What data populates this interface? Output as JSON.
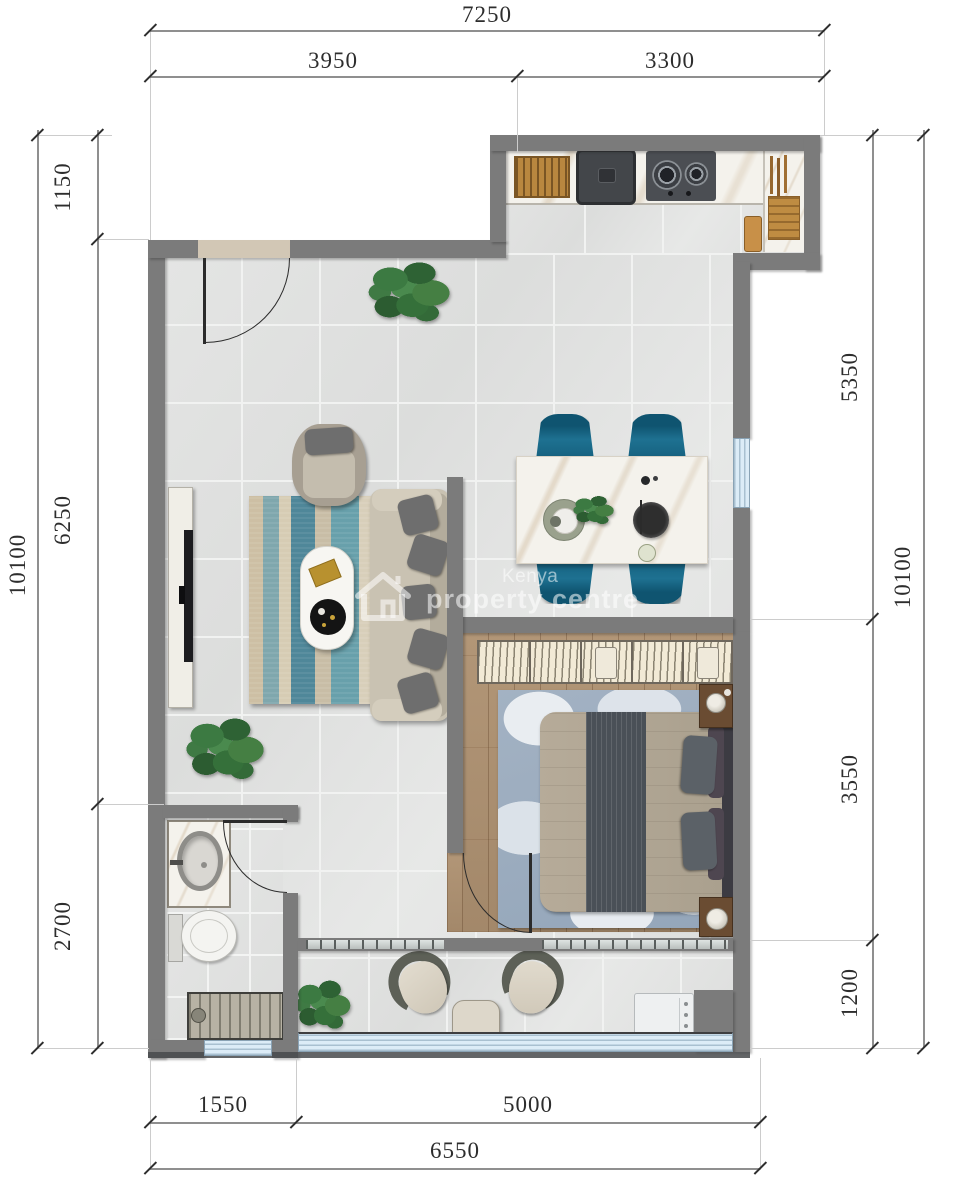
{
  "plan": {
    "watermark": {
      "brand_top": "Kenya",
      "brand_bottom": "property centre"
    },
    "dimensions_mm": {
      "top_total": "7250",
      "top_segments": [
        "3950",
        "3300"
      ],
      "bottom_total": "6550",
      "bottom_segments": [
        "1550",
        "5000"
      ],
      "left_total": "10100",
      "left_segments": [
        "1150",
        "6250",
        "2700"
      ],
      "right_total": "10100",
      "right_segments": [
        "5350",
        "3550",
        "1200"
      ]
    },
    "colors": {
      "wall": "#7b7b7b",
      "tile_floor": "#e1e2e1",
      "wood_floor": "#ab9071",
      "window_glass": "#dcecf7",
      "dining_chair_teal": "#1a6e8d",
      "living_rug_teal": "#5e99a6",
      "bedroom_rug_blue": "#9fb0c2",
      "plant_green": "#3c7a42"
    },
    "rooms": [
      "kitchen",
      "living-room",
      "dining-area",
      "bedroom",
      "bathroom",
      "balcony"
    ],
    "furniture": [
      "dish-rack",
      "kitchen-sink",
      "gas-stove",
      "dining-table",
      "dining-chairs",
      "tv-console",
      "armchair",
      "sofa",
      "coffee-table",
      "area-rug",
      "wardrobe",
      "double-bed",
      "nightstands",
      "bedroom-rug",
      "bathroom-vanity",
      "toilet",
      "shower-mat",
      "balcony-chairs",
      "balcony-table",
      "washing-machine",
      "potted-plants"
    ]
  }
}
